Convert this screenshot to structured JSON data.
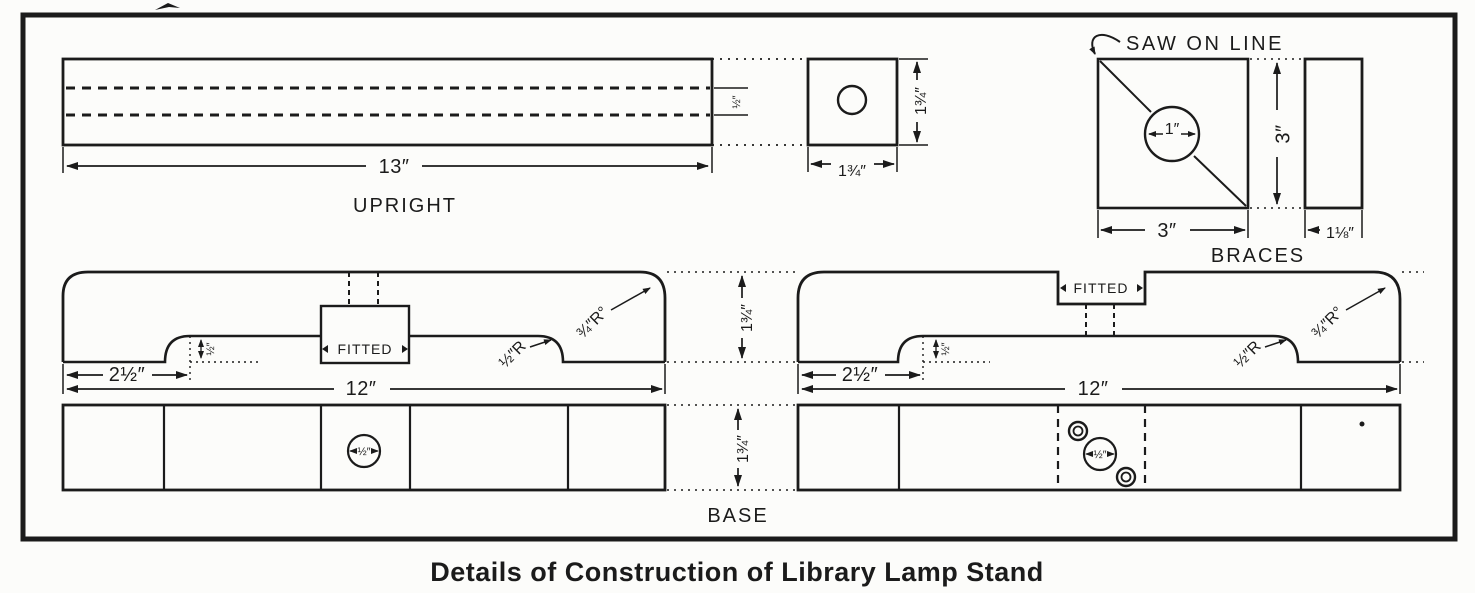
{
  "caption": "Details of Construction of Library Lamp Stand",
  "upright": {
    "label": "UPRIGHT",
    "length": "13″",
    "channel": "½″",
    "end_width": "1¾″",
    "end_height": "1¾″"
  },
  "braces": {
    "label": "BRACES",
    "saw_note": "SAW ON LINE",
    "hole": "1″",
    "height": "3″",
    "width": "3″",
    "thickness": "1⅛″"
  },
  "base": {
    "label": "BASE",
    "thickness": "1¾″",
    "plan_thickness": "1¾″",
    "side_left": {
      "fitted": "FITTED",
      "foot": "2½″",
      "length": "12″",
      "step": "½″",
      "fillet_radius": "½″R",
      "corner_radius": "¾″R°"
    },
    "side_right": {
      "fitted": "FITTED",
      "foot": "2½″",
      "length": "12″",
      "step": "½″",
      "fillet_radius": "½″R",
      "corner_radius": "¾″R°"
    },
    "plan_left": {
      "hole": "½″"
    },
    "plan_right": {
      "hole": "½″"
    }
  },
  "colors": {
    "ink": "#1b1b1b",
    "paper": "#fcfcfa"
  }
}
